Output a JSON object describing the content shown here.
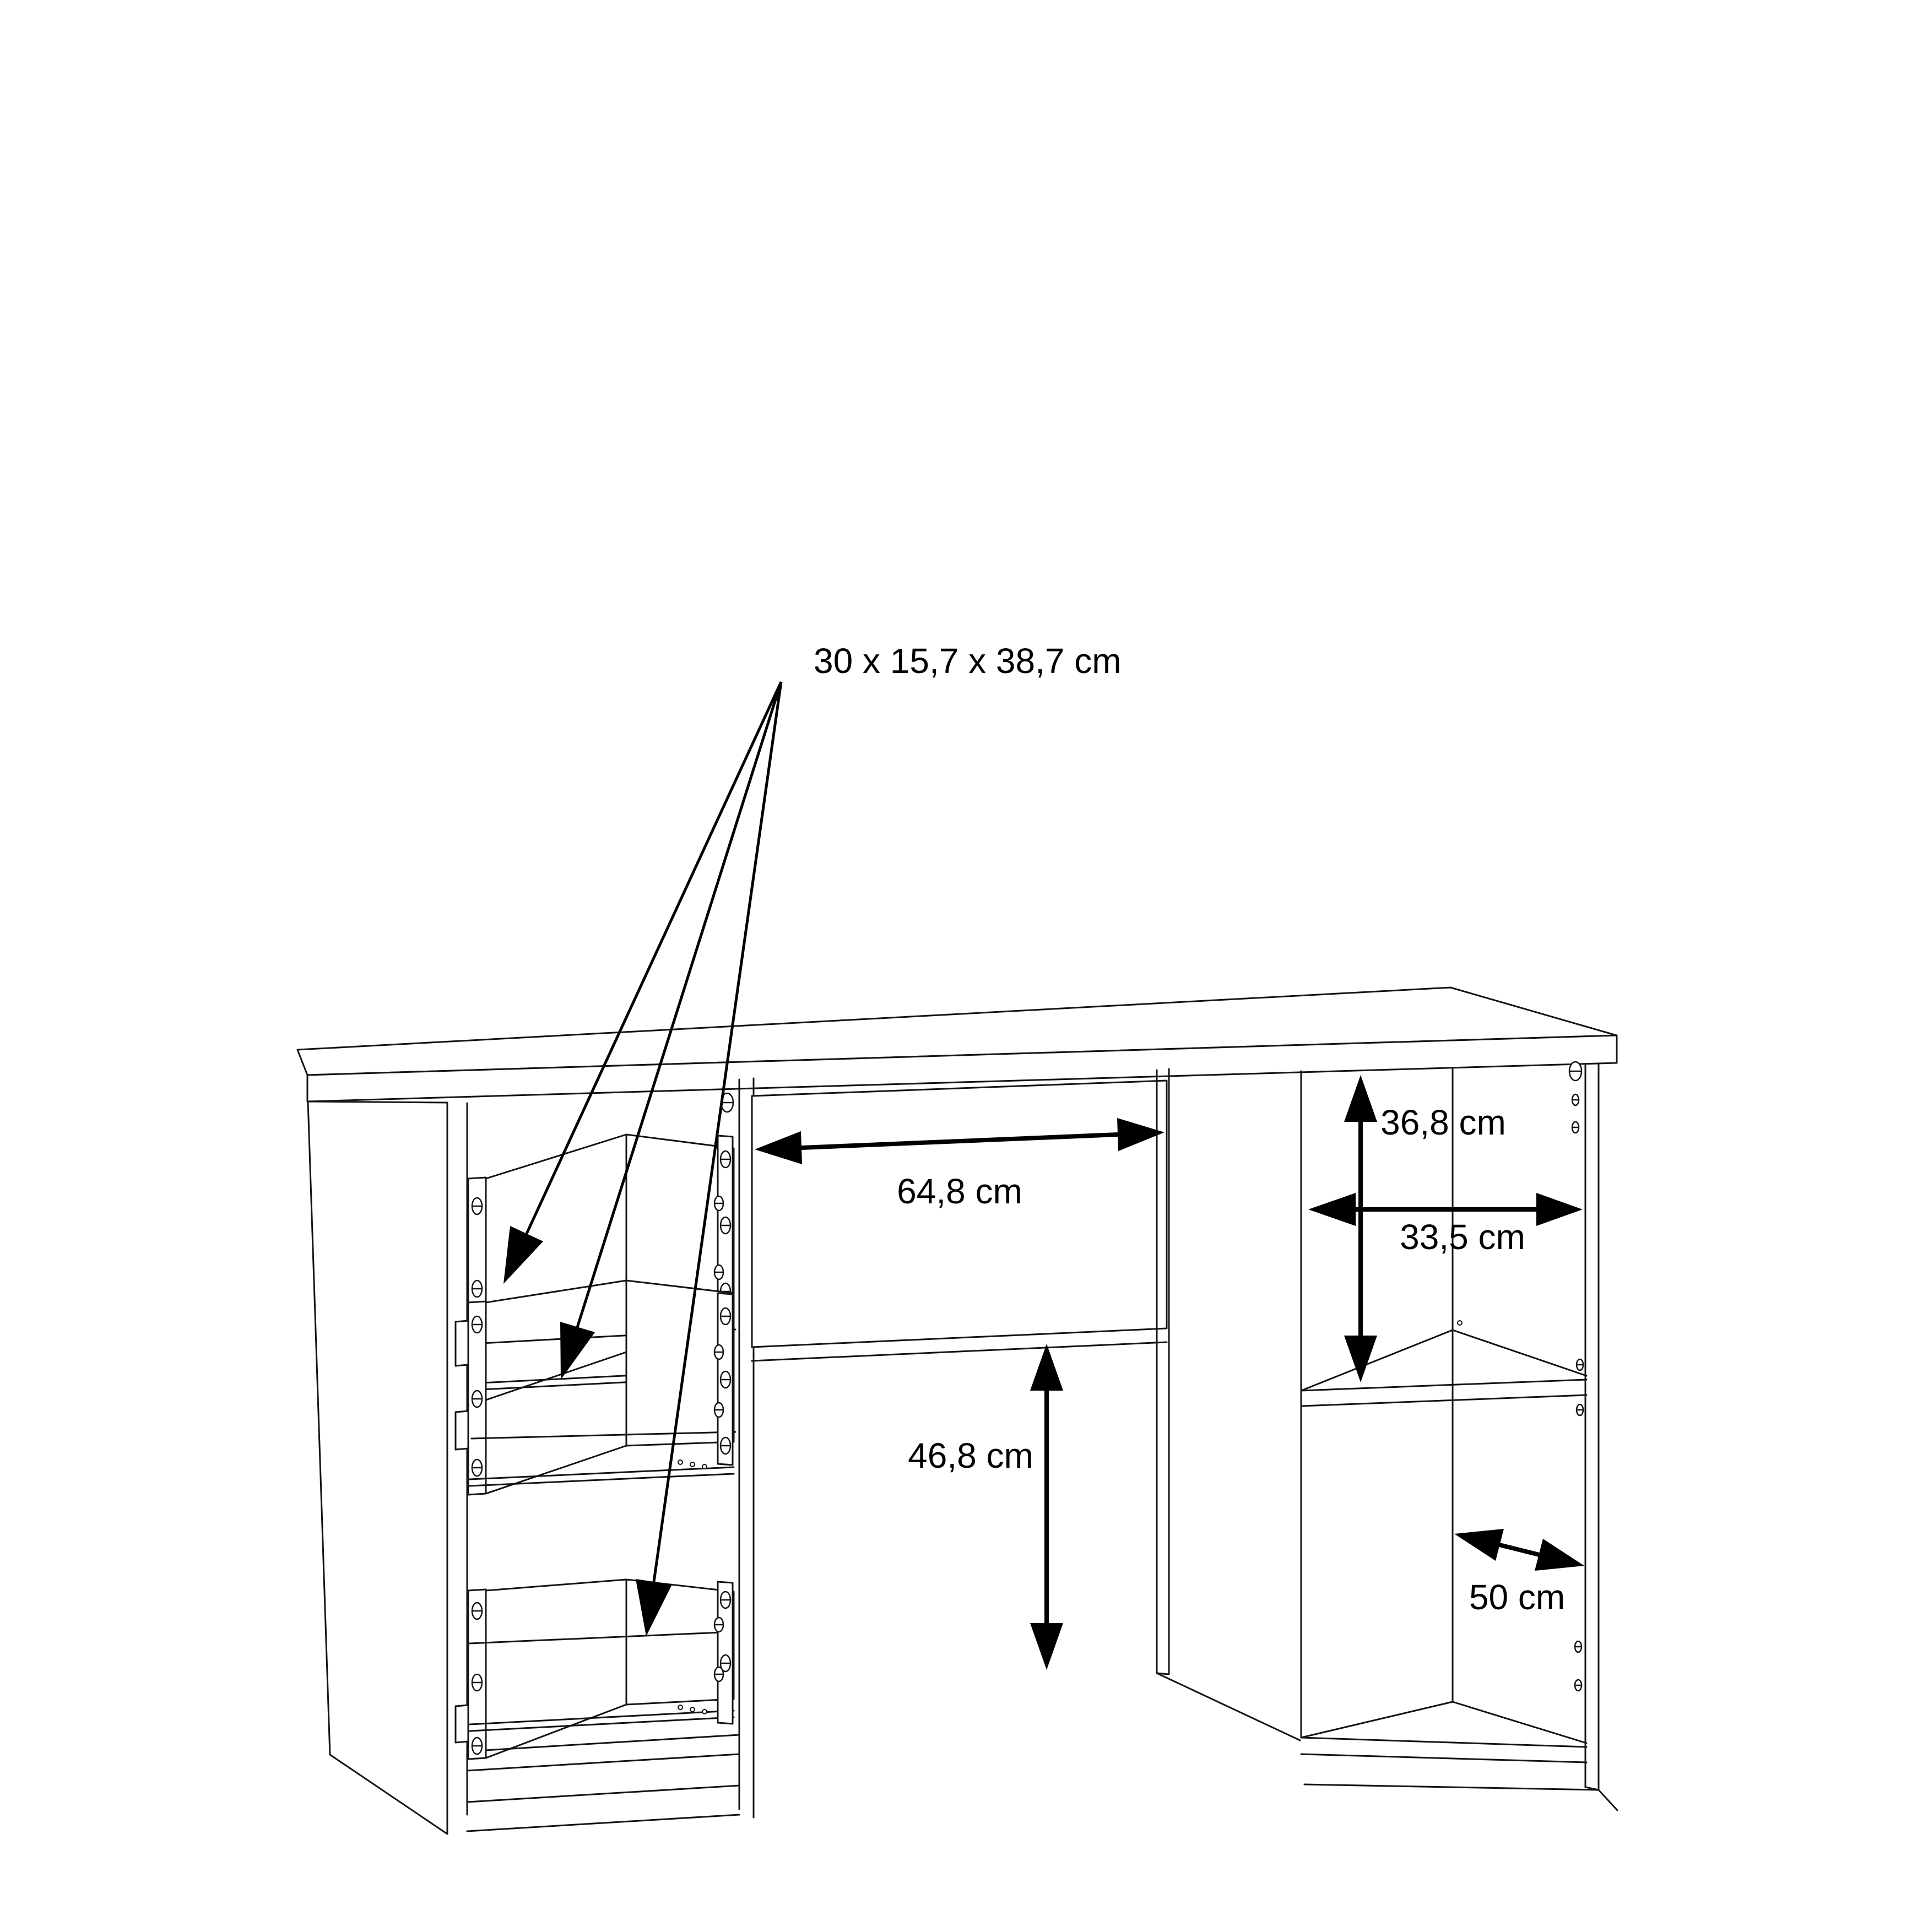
{
  "diagram": {
    "type": "furniture-dimension-drawing",
    "product": "desk with drawer pedestal and shelf pedestal",
    "background_color": "#ffffff",
    "line_color": "#141414",
    "annotation_color": "#000000",
    "labels": {
      "drawer_size": "30 x 15,7 x 38,7 cm",
      "middle_drawer_width": "64,8 cm",
      "upper_compartment_height": "36,8 cm",
      "compartment_width": "33,5 cm",
      "knee_space_height": "46,8 cm",
      "compartment_depth": "50 cm"
    }
  }
}
